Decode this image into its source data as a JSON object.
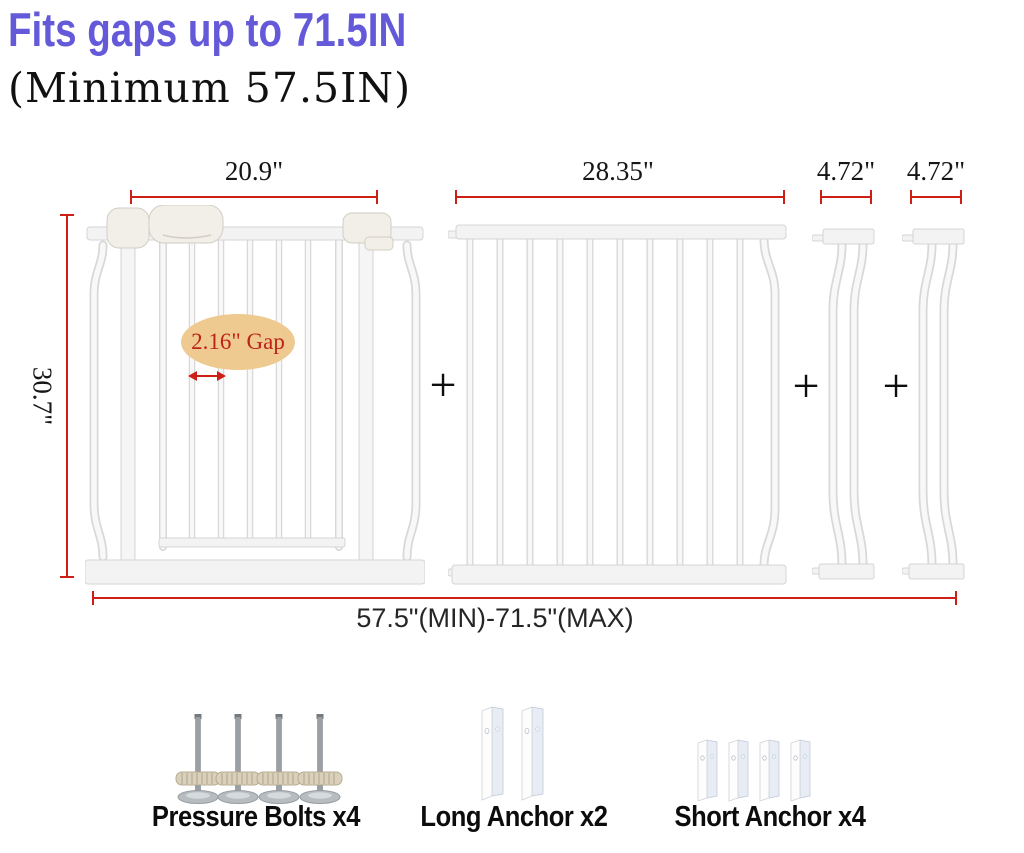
{
  "header": {
    "title": "Fits gaps up to 71.5IN",
    "subtitle": "(Minimum 57.5IN)"
  },
  "measurements": {
    "gate_width": "20.9\"",
    "extension_panel_width": "28.35\"",
    "small_extension_1_width": "4.72\"",
    "small_extension_2_width": "4.72\"",
    "gate_height": "30.7\"",
    "total_range": "57.5\"(MIN)-71.5\"(MAX)",
    "bar_gap": "2.16\" Gap"
  },
  "operators": {
    "plus": "+"
  },
  "hardware": {
    "items": [
      {
        "label": "Pressure Bolts x4",
        "icon": "pressure-bolt-icon"
      },
      {
        "label": "Long Anchor x2",
        "icon": "long-anchor-icon"
      },
      {
        "label": "Short Anchor x4",
        "icon": "short-anchor-icon"
      }
    ]
  },
  "colors": {
    "accent_red": "#cd1f16",
    "title_purple": "#6459d8",
    "gap_ellipse_fill": "#eeca90",
    "gate_white": "#f5f5f5"
  }
}
